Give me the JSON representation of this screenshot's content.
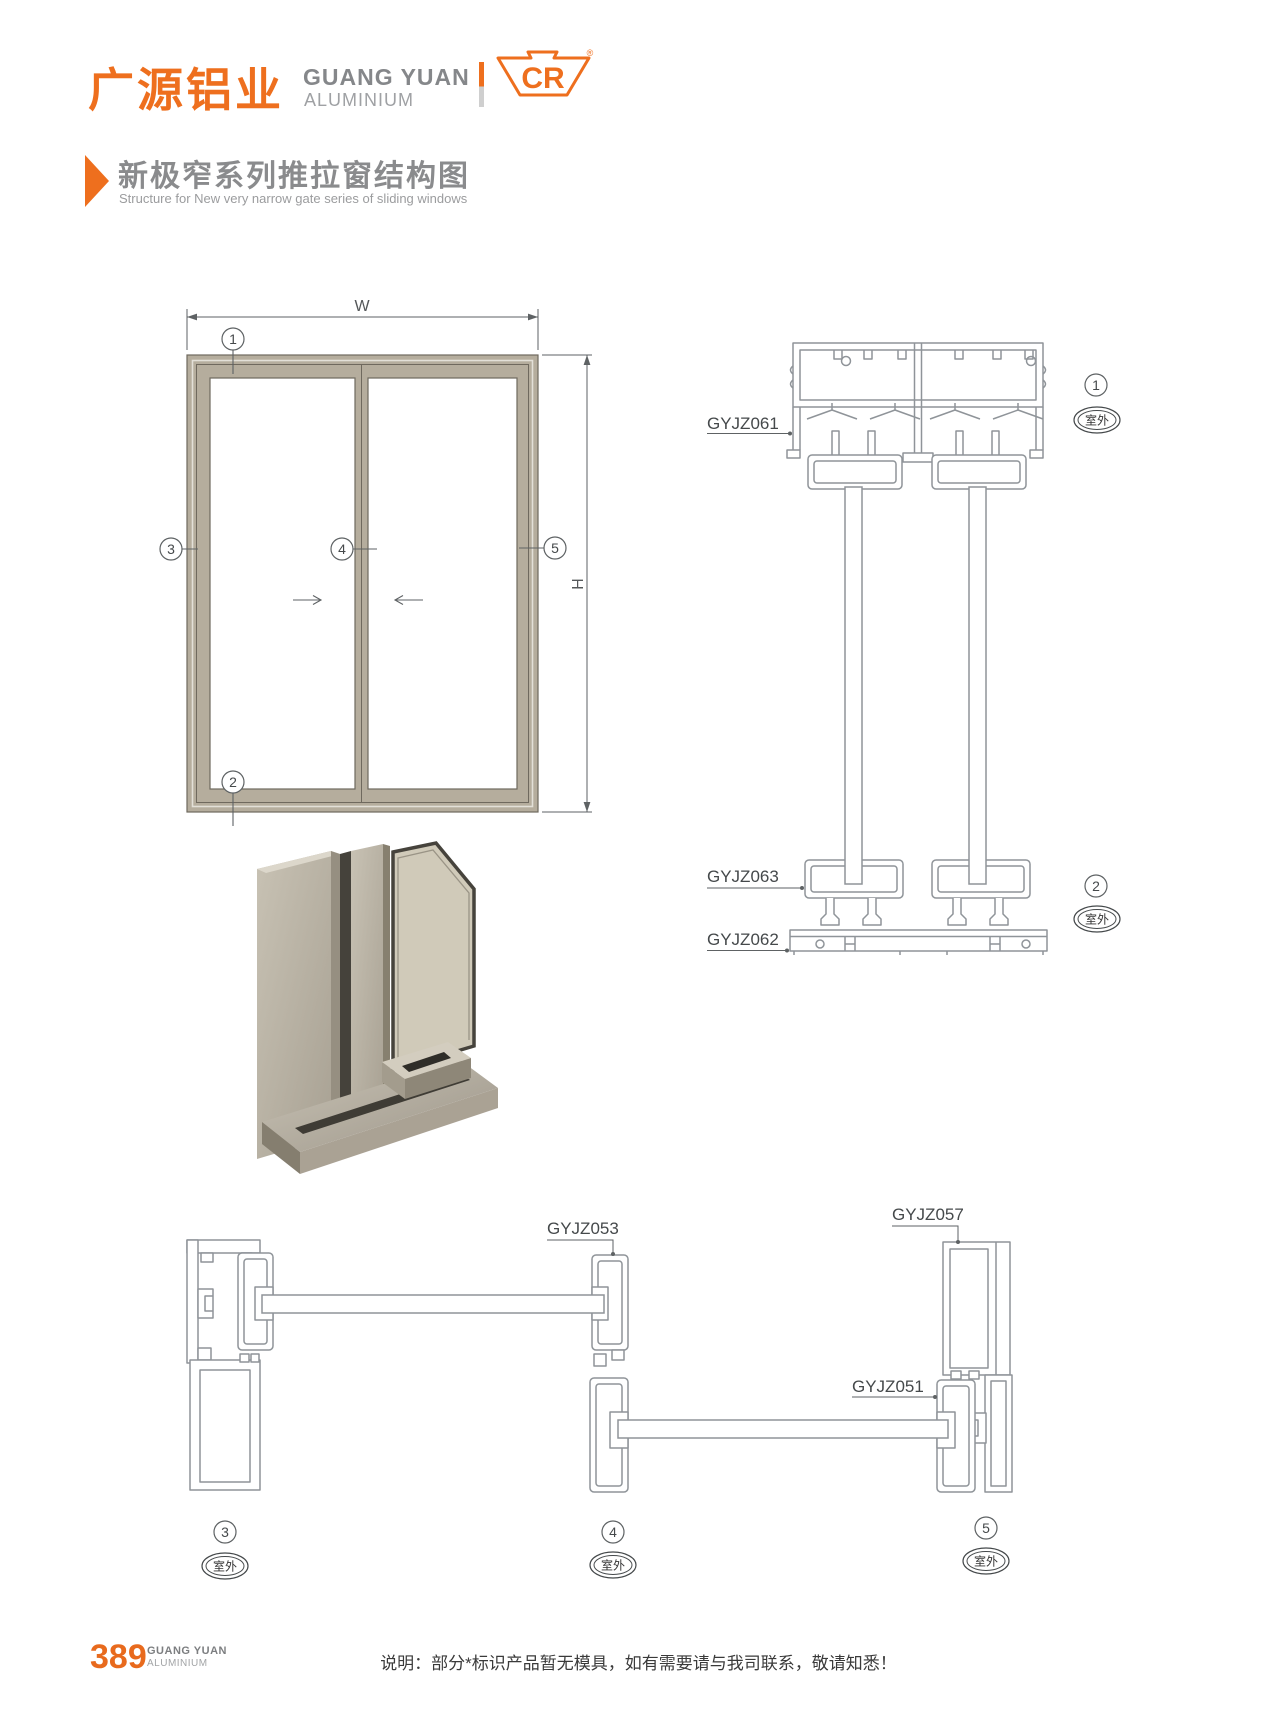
{
  "header": {
    "logo_cn": "广源铝业",
    "logo_en_line1": "GUANG YUAN",
    "logo_en_line2": "ALUMINIUM",
    "cr_text": "CR",
    "registered_mark": "®"
  },
  "title": {
    "cn": "新极窄系列推拉窗结构图",
    "en": "Structure for New very narrow gate series of sliding windows"
  },
  "elevation": {
    "width_label": "W",
    "height_label": "H"
  },
  "callouts": {
    "n1": "1",
    "n2": "2",
    "n3": "3",
    "n4": "4",
    "n5": "5",
    "outdoor": "室外"
  },
  "profiles": {
    "head": "GYJZ061",
    "sash_bottom": "GYJZ063",
    "sill": "GYJZ062",
    "meeting_stile": "GYJZ053",
    "right_jamb": "GYJZ057",
    "sash_stile": "GYJZ051"
  },
  "footer": {
    "page_number": "389",
    "brand_line1": "GUANG YUAN",
    "brand_line2": "ALUMINIUM",
    "note": "说明：部分*标识产品暂无模具，如有需要请与我司联系，敬请知悉！"
  },
  "colors": {
    "accent_orange": "#ee6f1e",
    "frame_tan": "#b5ad9d",
    "profile_line": "#8f9499",
    "dim_line": "#5e6264",
    "title_gray": "#8a8b8d"
  }
}
